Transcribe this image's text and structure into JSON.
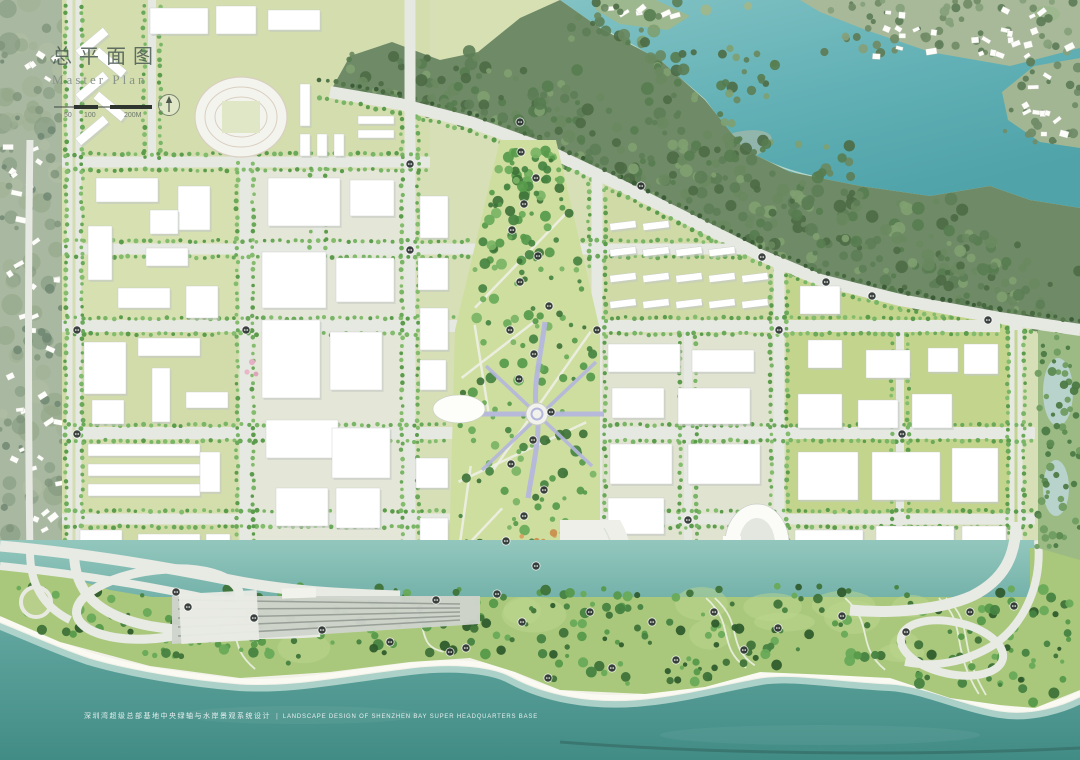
{
  "page": {
    "type": "master-plan-rendering"
  },
  "title_block": {
    "title_cn": "总平面图",
    "title_en": "Master Plan",
    "scale_labels": [
      "50",
      "100",
      "200M"
    ]
  },
  "caption": {
    "cn": "深圳湾超级总部基地中央绿轴与水岸景观系统设计",
    "divider": "|",
    "en": "LANDSCAPE DESIGN OF SHENZHEN BAY SUPER HEADQUARTERS BASE"
  },
  "colors": {
    "base": "#d8dfc3",
    "hill": "#a9b8a0",
    "forest": "#6f8a66",
    "lakeTop": "#82c2c4",
    "lakeBottom": "#52a6ac",
    "seaTop": "#8ec4ba",
    "seaBottom": "#428c86",
    "road": "#e6e8e2",
    "roadDim": "#dfe2dc",
    "building": "#ffffff",
    "buildingShadow": "#c3c8c2",
    "lawn": "#d6dfb6",
    "lawnBright": "#c3d48d",
    "axis": "#cede9f",
    "park": "#a9c87c",
    "tree": "#6aa85a",
    "treeDark": "#46693f",
    "sand": "#f2f2e9",
    "walkway": "#b4b6dc",
    "marker": "#2f3633",
    "inkTitle": "#4a5a52",
    "inkSub": "#808c85",
    "captionColor": "rgba(255,255,255,0.85)"
  },
  "markers": [
    [
      521,
      152
    ],
    [
      536,
      178
    ],
    [
      524,
      204
    ],
    [
      512,
      230
    ],
    [
      538,
      256
    ],
    [
      520,
      282
    ],
    [
      549,
      306
    ],
    [
      510,
      330
    ],
    [
      534,
      354
    ],
    [
      519,
      379
    ],
    [
      551,
      412
    ],
    [
      533,
      440
    ],
    [
      511,
      464
    ],
    [
      544,
      490
    ],
    [
      524,
      516
    ],
    [
      506,
      541
    ],
    [
      536,
      566
    ],
    [
      497,
      594
    ],
    [
      522,
      622
    ],
    [
      466,
      648
    ],
    [
      436,
      600
    ],
    [
      188,
      607
    ],
    [
      254,
      618
    ],
    [
      322,
      630
    ],
    [
      390,
      642
    ],
    [
      450,
      652
    ],
    [
      590,
      612
    ],
    [
      652,
      622
    ],
    [
      714,
      612
    ],
    [
      778,
      628
    ],
    [
      842,
      616
    ],
    [
      906,
      632
    ],
    [
      970,
      612
    ],
    [
      744,
      650
    ],
    [
      676,
      660
    ],
    [
      612,
      668
    ],
    [
      548,
      678
    ],
    [
      1014,
      606
    ],
    [
      77,
      330
    ],
    [
      77,
      434
    ],
    [
      246,
      330
    ],
    [
      410,
      250
    ],
    [
      597,
      330
    ],
    [
      779,
      330
    ],
    [
      688,
      520
    ],
    [
      902,
      434
    ],
    [
      641,
      186
    ],
    [
      762,
      257
    ],
    [
      872,
      296
    ],
    [
      988,
      320
    ],
    [
      520,
      122
    ],
    [
      410,
      164
    ],
    [
      826,
      282
    ],
    [
      176,
      592
    ]
  ]
}
